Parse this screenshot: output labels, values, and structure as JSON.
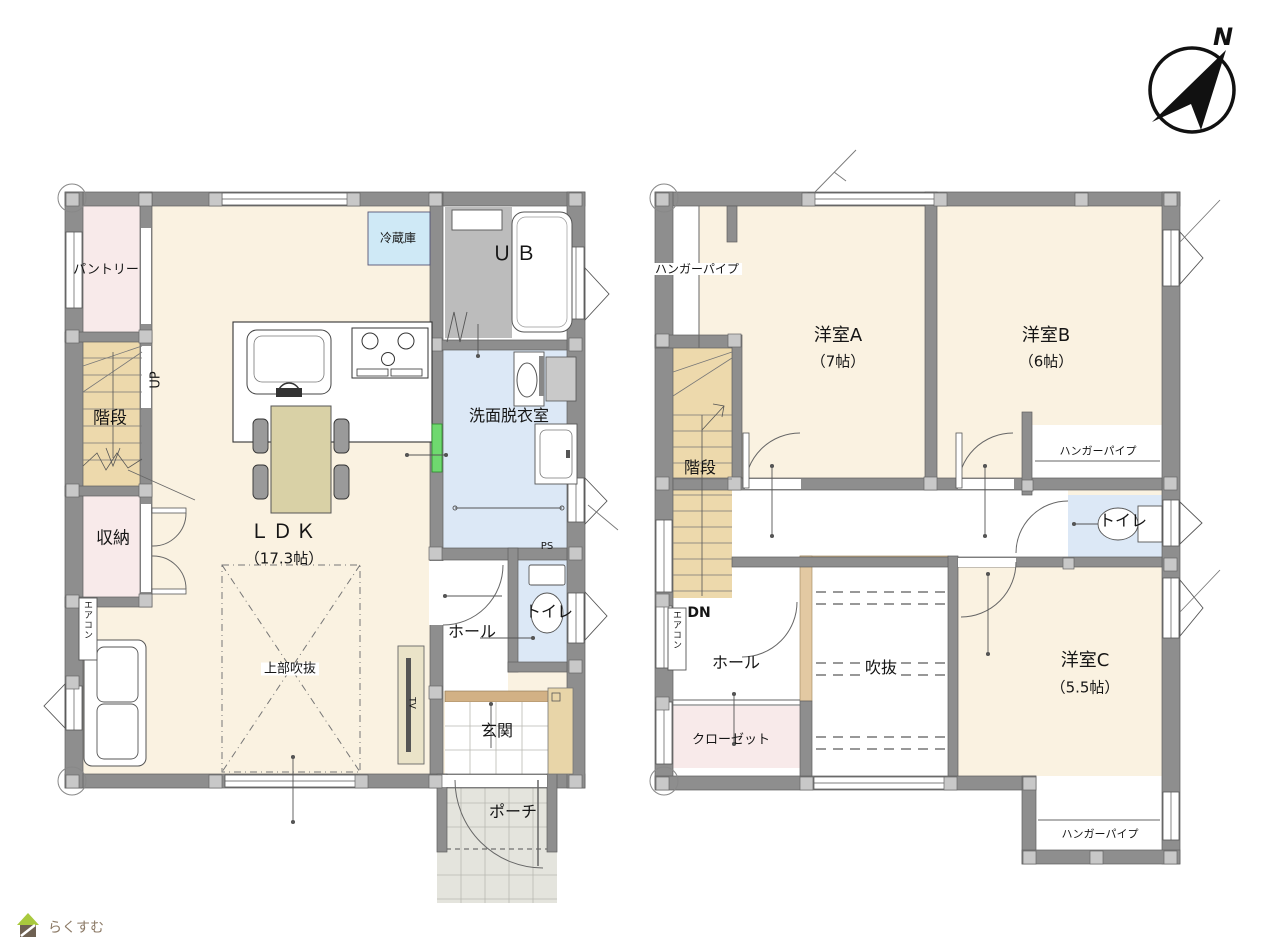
{
  "compass": {
    "north": "N"
  },
  "logo": {
    "brand": "らくすむ"
  },
  "floor1": {
    "rooms": {
      "pantry": "パントリー",
      "stairs": "階段",
      "stairs_up": "UP",
      "storage": "収納",
      "aircon": "エアコン",
      "ldk": "ＬＤＫ",
      "ldk_size": "（17.3帖）",
      "void_above": "上部吹抜",
      "fridge": "冷蔵庫",
      "unit_bath": "ＵＢ",
      "washroom": "洗面脱衣室",
      "pipe_space": "PS",
      "hall": "ホール",
      "toilet": "トイレ",
      "entrance": "玄関",
      "porch": "ポーチ",
      "tv": "TV"
    }
  },
  "floor2": {
    "rooms": {
      "hanger_pipe_a": "ハンガーパイプ",
      "room_a": "洋室A",
      "room_a_size": "（7帖）",
      "room_b": "洋室B",
      "room_b_size": "（6帖）",
      "stairs": "階段",
      "stairs_dn": "DN",
      "aircon": "エアコン",
      "hanger_pipe_b": "ハンガーパイプ",
      "toilet": "トイレ",
      "hall": "ホール",
      "void": "吹抜",
      "closet": "クローゼット",
      "room_c": "洋室C",
      "room_c_size": "（5.5帖）",
      "hanger_pipe_c": "ハンガーパイプ"
    }
  }
}
